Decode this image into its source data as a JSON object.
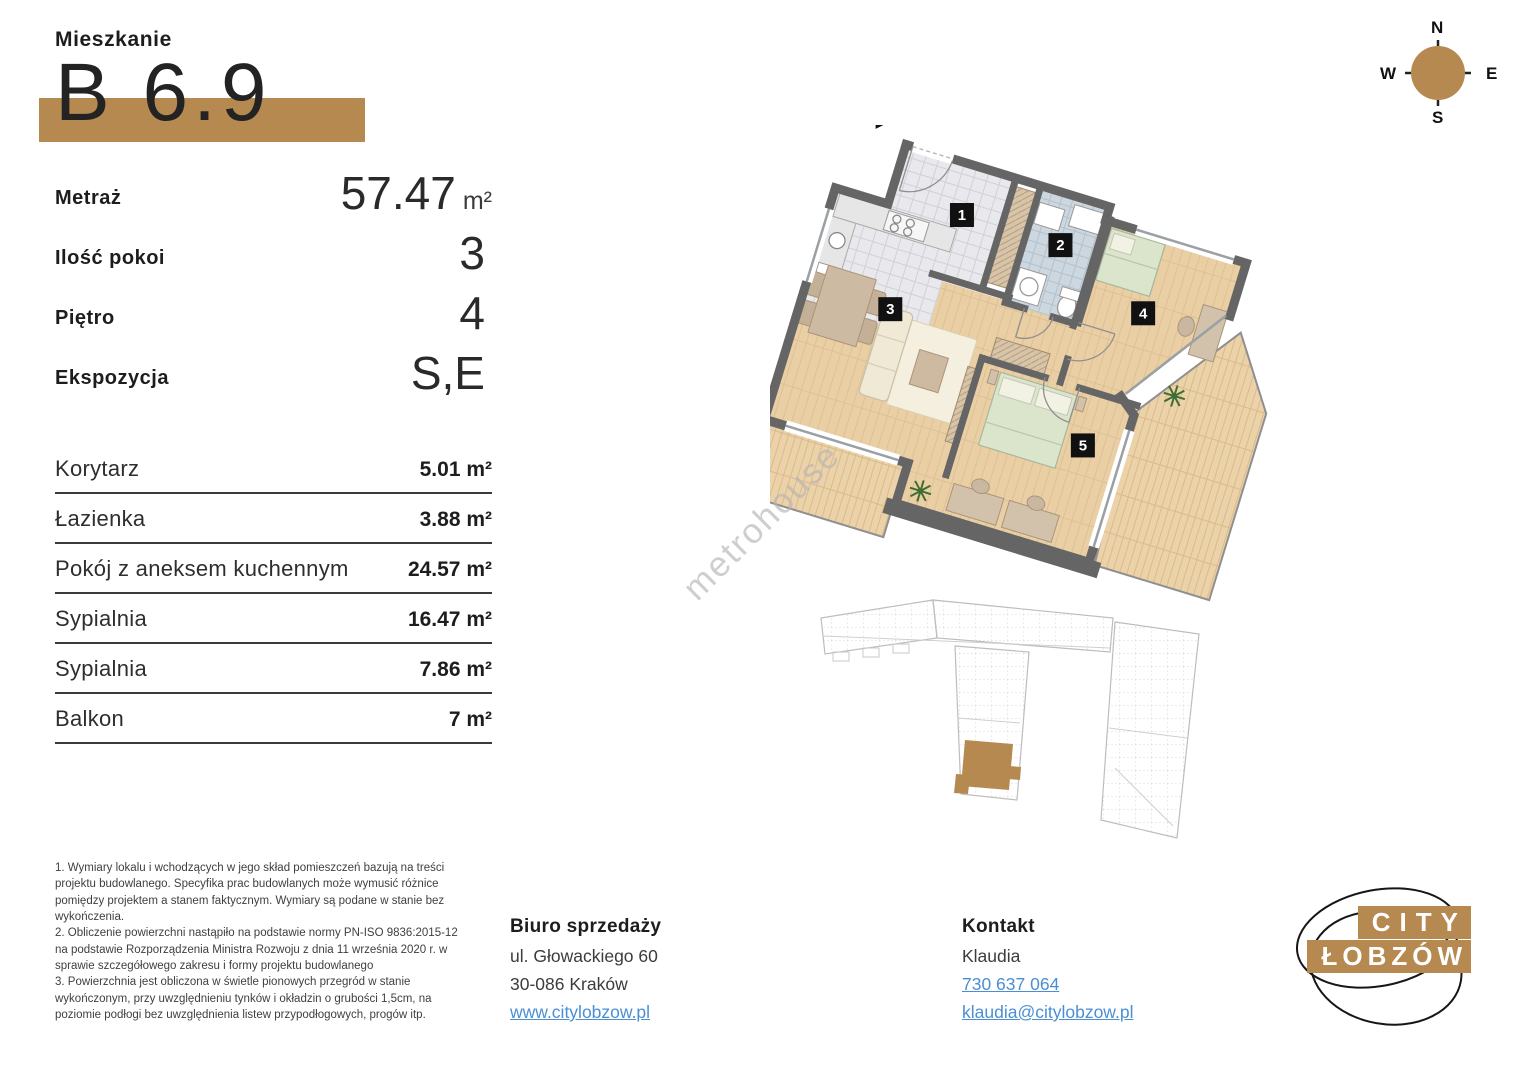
{
  "header": {
    "label": "Mieszkanie",
    "unit_number": "B 6.9"
  },
  "stats": [
    {
      "label": "Metraż",
      "value": "57.47",
      "unit": "m²"
    },
    {
      "label": "Ilość pokoi",
      "value": "3",
      "unit": ""
    },
    {
      "label": "Piętro",
      "value": "4",
      "unit": ""
    },
    {
      "label": "Ekspozycja",
      "value": "S,E",
      "unit": ""
    }
  ],
  "room_table": [
    {
      "name": "Korytarz",
      "area": "5.01 m²"
    },
    {
      "name": "Łazienka",
      "area": "3.88 m²"
    },
    {
      "name": "Pokój z aneksem kuchennym",
      "area": "24.57 m²"
    },
    {
      "name": "Sypialnia",
      "area": "16.47 m²"
    },
    {
      "name": "Sypialnia",
      "area": "7.86 m²"
    },
    {
      "name": "Balkon",
      "area": "7 m²"
    }
  ],
  "floor_plan": {
    "room_numbers": [
      "1",
      "2",
      "3",
      "4",
      "5"
    ],
    "watermark": "metrohouse"
  },
  "compass": {
    "n": "N",
    "e": "E",
    "s": "S",
    "w": "W"
  },
  "footnotes": [
    "1. Wymiary lokalu i wchodzących w jego skład pomieszczeń bazują na treści projektu budowlanego. Specyfika prac budowlanych może wymusić różnice pomiędzy projektem a stanem faktycznym. Wymiary są podane w stanie bez wykończenia.",
    "2. Obliczenie powierzchni nastąpiło na podstawie normy PN-ISO 9836:2015-12 na podstawie Rozporządzenia Ministra Rozwoju z dnia 11 września 2020 r. w sprawie szczegółowego zakresu i formy projektu budowlanego",
    "3. Powierzchnia jest obliczona w świetle pionowych przegród w stanie wykończonym, przy uwzględnieniu tynków i okładzin o grubości 1,5cm, na poziomie podłogi bez uwzględnienia listew przypodłogowych, progów itp."
  ],
  "sales_office": {
    "title": "Biuro sprzedaży",
    "address_line1": "ul. Głowackiego 60",
    "address_line2": "30-086 Kraków",
    "website": "www.citylobzow.pl"
  },
  "contact": {
    "title": "Kontakt",
    "name": "Klaudia",
    "phone": "730 637 064",
    "email": "klaudia@citylobzow.pl"
  },
  "logo": {
    "line1": "CITY",
    "line2": "ŁOBZÓW"
  },
  "colors": {
    "accent": "#b5894f",
    "link": "#4a8fd3",
    "wall": "#656565",
    "floor": "#eacfa4"
  }
}
